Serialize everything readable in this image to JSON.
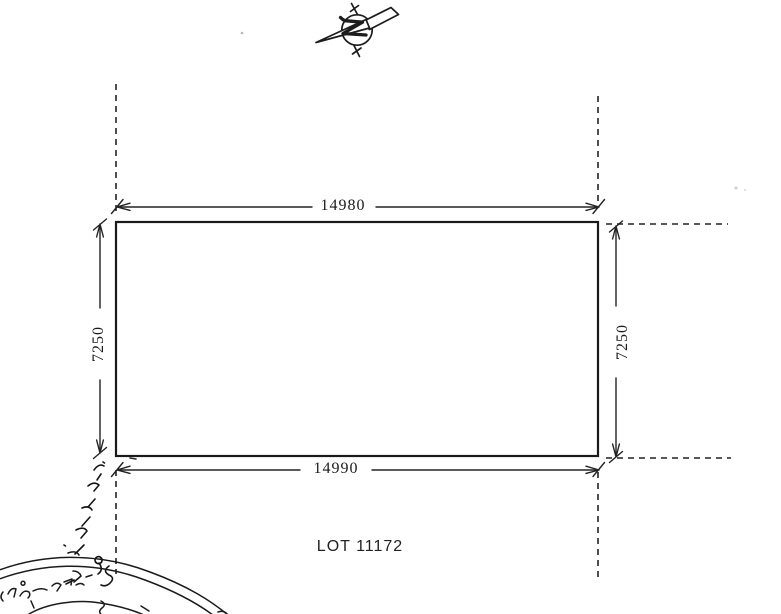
{
  "page": {
    "paper_color": "#ffffff",
    "ink_color": "#1f1f1f"
  },
  "north_arrow": {
    "icon": "north-arrow-compass"
  },
  "parcel": {
    "lot_label": "LOT 11172",
    "dimensions": {
      "top": "14980",
      "bottom": "14990",
      "left": "7250",
      "right": "7250"
    }
  },
  "annotations": {
    "handwritten_note": "handwritten Thaana script (illegible)",
    "stamp": "partial circular stamp (illegible handwriting)"
  }
}
